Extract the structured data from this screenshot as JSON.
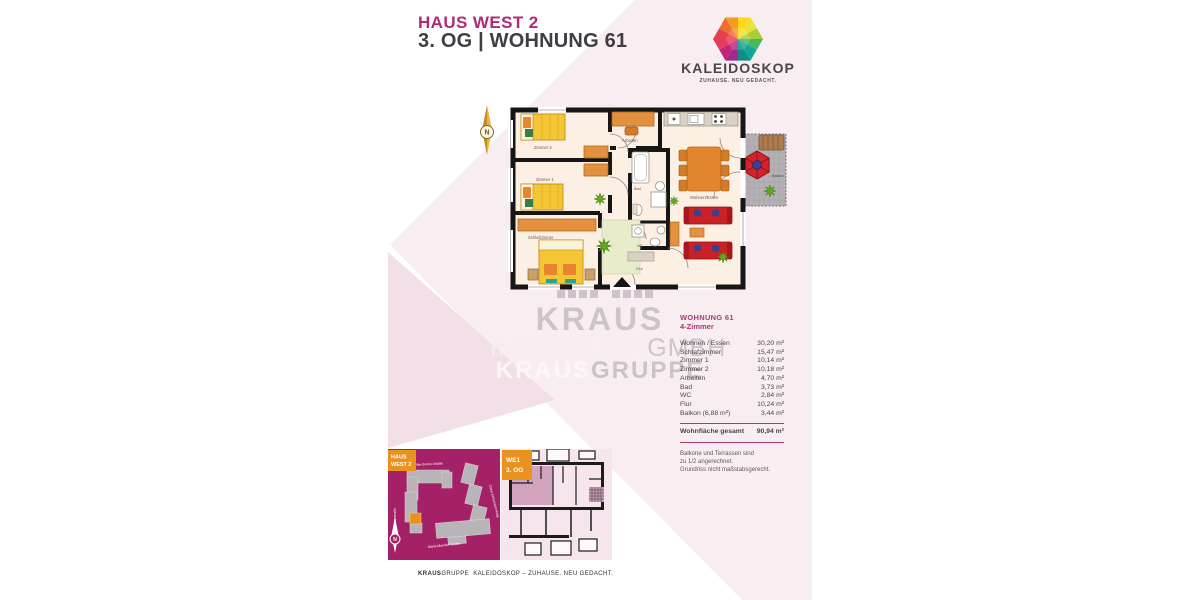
{
  "header": {
    "title": "HAUS WEST 2",
    "subtitle": "3. OG | WOHNUNG 61"
  },
  "logo": {
    "name": "KALEIDOSKOP",
    "tagline": "ZUHAUSE. NEU GEDACHT."
  },
  "compass": {
    "label": "N"
  },
  "floorplan": {
    "rooms": {
      "zimmer2": "Zimmer 2",
      "zimmer1": "Zimmer 1",
      "schlafzimmer": "Schlafzimmer",
      "arbeiten": "Arbeiten",
      "bad": "Bad",
      "wc": "WC",
      "flur": "Flur",
      "wohnen_essen": "Wohnen/Essen",
      "balkon": "Balkon"
    }
  },
  "watermark": {
    "line1": "KRAUS",
    "line2_light": "IMMOBILIEN",
    "line2_dark": "GMBH",
    "line3_light": "KRAUS",
    "line3_dark": "GRUPPE"
  },
  "area_table": {
    "title": "WOHNUNG 61",
    "subtitle": "4-Zimmer",
    "rows": [
      {
        "label": "Wohnen / Essen",
        "value": "30,20 m²"
      },
      {
        "label": "Schlafzimmer",
        "value": "15,47 m²"
      },
      {
        "label": "Zimmer 1",
        "value": "10,14 m²"
      },
      {
        "label": "Zimmer 2",
        "value": "10,18 m²"
      },
      {
        "label": "Arbeiten",
        "value": "4,70 m²"
      },
      {
        "label": "Bad",
        "value": "3,73 m²"
      },
      {
        "label": "WC",
        "value": "2,84 m²"
      },
      {
        "label": "Flur",
        "value": "10,24 m²"
      },
      {
        "label": "Balkon (6,88 m²)",
        "value": "3,44 m²"
      }
    ],
    "total": {
      "label": "Wohnfläche gesamt",
      "value": "90,94 m²"
    },
    "note_lines": [
      "Balkone und Terrassen sind",
      "zu 1/2 angerechnet.",
      "Grundriss nicht maßstabsgerecht."
    ]
  },
  "site_plan": {
    "badge_line1": "HAUS",
    "badge_line2": "WEST 2",
    "streets": {
      "top": "Hilde-Domin-Straße",
      "right": "Clara-Schumann-Weg",
      "bottom": "Maria-Mancke-Straße",
      "left": "Jahnstraße"
    },
    "compass_label": "N"
  },
  "unit_plan": {
    "badge_line1": "WE1",
    "badge_line2": "3. OG"
  },
  "footer": {
    "brand_bold": "KRAUS",
    "brand_rest": "GRUPPE",
    "text": "KALEIDOSKOP – ZUHAUSE. NEU GEDACHT."
  },
  "colors": {
    "brand_magenta": "#b12973",
    "accent_orange": "#ea921e",
    "site_plan_bg": "#a52167",
    "page_pink": "#f8eef2",
    "page_pink_dark": "#f3dfe7",
    "wall_black": "#161616",
    "sofa_red": "#c92127",
    "bed_yellow": "#f4c535",
    "furniture_orange": "#e39140",
    "logo_mosaic": [
      "#e8404b",
      "#ee6e30",
      "#f59d1e",
      "#fdd718",
      "#e9e23a",
      "#a8ce3b",
      "#46b864",
      "#12a79b",
      "#0f8d85",
      "#a02b90",
      "#c42378",
      "#e73a63"
    ]
  }
}
